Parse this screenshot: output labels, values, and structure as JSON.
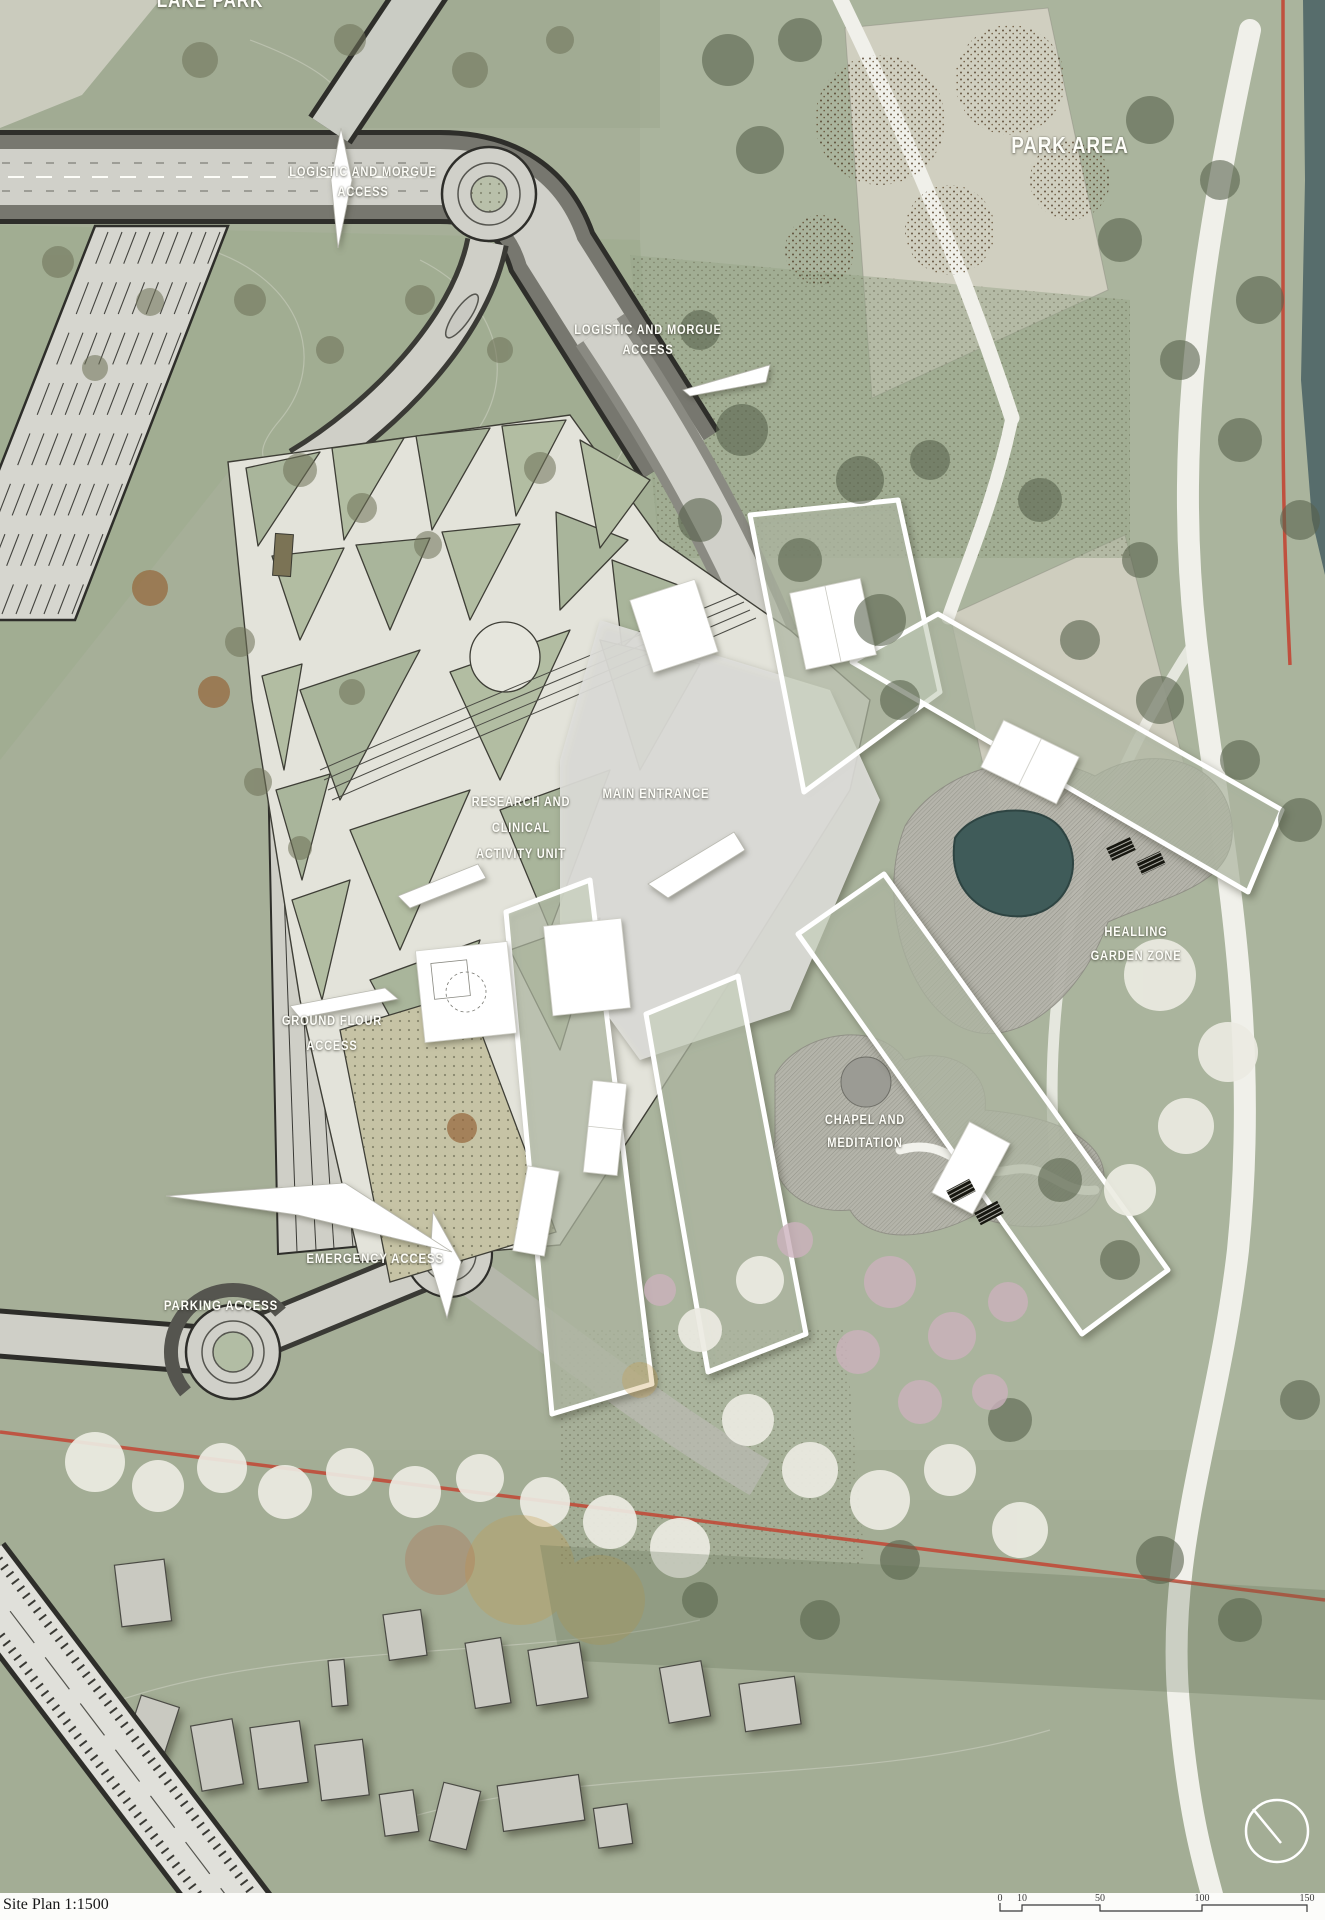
{
  "map_labels": {
    "corner_park": "LAKE PARK",
    "park_area": "PARK AREA",
    "logistic_access_north": {
      "line1": "LOGISTIC AND MORGUE",
      "line2": "ACCESS"
    },
    "logistic_access_east": {
      "line1": "LOGISTIC AND MORGUE",
      "line2": "ACCESS"
    },
    "research_unit": {
      "line1": "RESEARCH AND",
      "line2": "CLINICAL",
      "line3": "ACTIVITY UNIT"
    },
    "main_entrance": "MAIN ENTRANCE",
    "healing_garden": {
      "line1": "HEALLING",
      "line2": "GARDEN ZONE"
    },
    "ground_floor_access": {
      "line1": "GROUND FLOUR",
      "line2": "ACCESS"
    },
    "chapel": {
      "line1": "CHAPEL AND",
      "line2": "MEDITATION"
    },
    "emergency_access": "EMERGENCY ACCESS",
    "parking_access": "PARKING ACCESS"
  },
  "footer": {
    "plan_title": "Site Plan 1:1500"
  },
  "scale_bar": {
    "ticks": [
      "0",
      "10",
      "50",
      "100",
      "150"
    ]
  },
  "colors": {
    "site_green": "#a6af98",
    "park_green": "#aeb7a0",
    "path_cream": "#e3e3da",
    "road_light": "#d0d0c9",
    "road_dark": "#2e2e2a",
    "accent_red": "#c24534",
    "pond_teal": "#3f5b59",
    "building_white": "#ffffff"
  }
}
